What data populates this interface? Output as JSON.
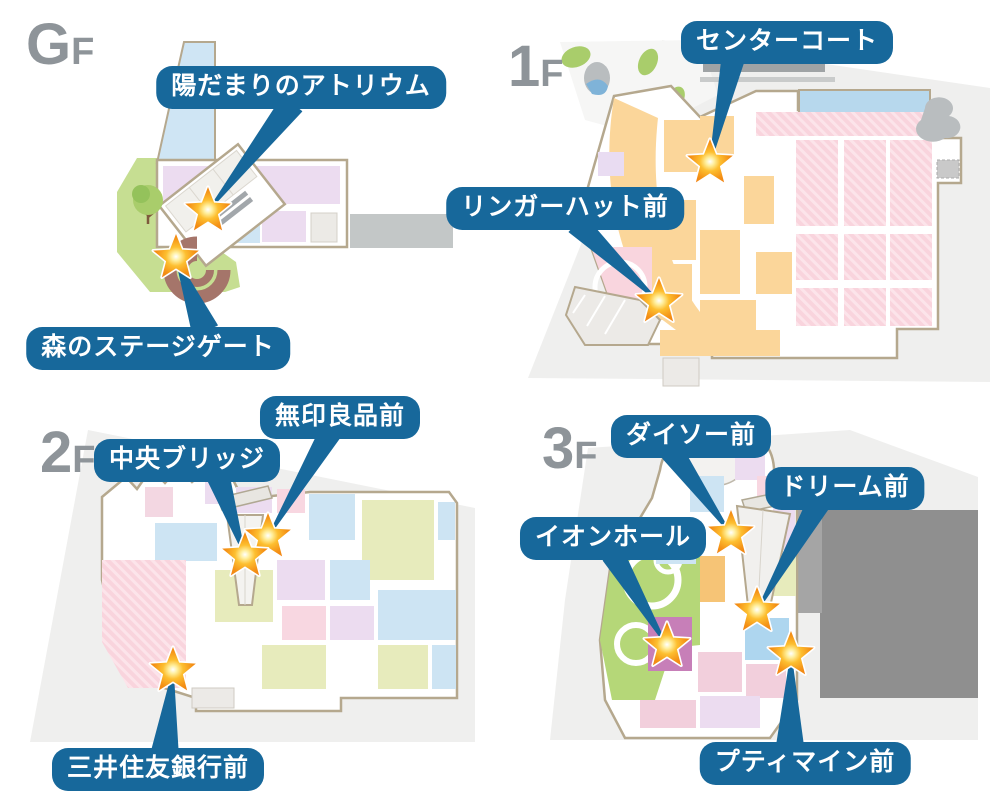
{
  "colors": {
    "bubble_bg": "#17689b",
    "bubble_text": "#ffffff",
    "floor_label": "#8e9499",
    "star_outer": "#f08114",
    "star_mid": "#fdbf30",
    "star_core": "#fff3c4",
    "star_stroke": "#ffffff",
    "map_outline": "#b5a88e",
    "map_backdrop": "#efefee"
  },
  "marker_icon": "star",
  "floors": [
    {
      "id": "gf",
      "label_main": "G",
      "label_sub": "F",
      "markers": [
        {
          "name": "陽だまりのアトリウム",
          "bubble": {
            "cx": 301,
            "top": 66
          },
          "star": {
            "x": 208,
            "y": 211
          },
          "tail": {
            "x": 292,
            "y": 104,
            "w": 24
          }
        },
        {
          "name": "森のステージゲート",
          "bubble": {
            "cx": 158,
            "top": 327
          },
          "star": {
            "x": 176,
            "y": 258
          },
          "tail": {
            "x": 205,
            "y": 330,
            "w": 26
          }
        }
      ]
    },
    {
      "id": "1f",
      "label_main": "1",
      "label_sub": "F",
      "markers": [
        {
          "name": "センターコート",
          "bubble": {
            "cx": 787,
            "top": 21
          },
          "star": {
            "x": 710,
            "y": 163
          },
          "tail": {
            "x": 733,
            "y": 59,
            "w": 22
          }
        },
        {
          "name": "リンガーハット前",
          "bubble": {
            "cx": 565,
            "top": 187
          },
          "star": {
            "x": 659,
            "y": 302
          },
          "tail": {
            "x": 577,
            "y": 224,
            "w": 22
          }
        }
      ]
    },
    {
      "id": "2f",
      "label_main": "2",
      "label_sub": "F",
      "markers": [
        {
          "name": "無印良品前",
          "bubble": {
            "cx": 340,
            "top": 396
          },
          "star": {
            "x": 268,
            "y": 537
          },
          "tail": {
            "x": 333,
            "y": 428,
            "w": 22
          }
        },
        {
          "name": "中央ブリッジ",
          "bubble": {
            "cx": 187,
            "top": 439
          },
          "star": {
            "x": 245,
            "y": 556
          },
          "tail": {
            "x": 218,
            "y": 476,
            "w": 22
          }
        },
        {
          "name": "三井住友銀行前",
          "bubble": {
            "cx": 158,
            "top": 748
          },
          "star": {
            "x": 173,
            "y": 671
          },
          "tail": {
            "x": 165,
            "y": 751,
            "w": 26
          }
        }
      ]
    },
    {
      "id": "3f",
      "label_main": "3",
      "label_sub": "F",
      "markers": [
        {
          "name": "ダイソー前",
          "bubble": {
            "cx": 691,
            "top": 415
          },
          "star": {
            "x": 731,
            "y": 534
          },
          "tail": {
            "x": 672,
            "y": 452,
            "w": 22
          }
        },
        {
          "name": "ドリーム前",
          "bubble": {
            "cx": 845,
            "top": 467
          },
          "star": {
            "x": 757,
            "y": 611
          },
          "tail": {
            "x": 818,
            "y": 504,
            "w": 22
          }
        },
        {
          "name": "イオンホール",
          "bubble": {
            "cx": 613,
            "top": 517
          },
          "star": {
            "x": 667,
            "y": 646
          },
          "tail": {
            "x": 613,
            "y": 555,
            "w": 22
          }
        },
        {
          "name": "プティマイン前",
          "bubble": {
            "cx": 805,
            "top": 742
          },
          "star": {
            "x": 791,
            "y": 655
          },
          "tail": {
            "x": 790,
            "y": 744,
            "w": 26
          }
        }
      ]
    }
  ]
}
